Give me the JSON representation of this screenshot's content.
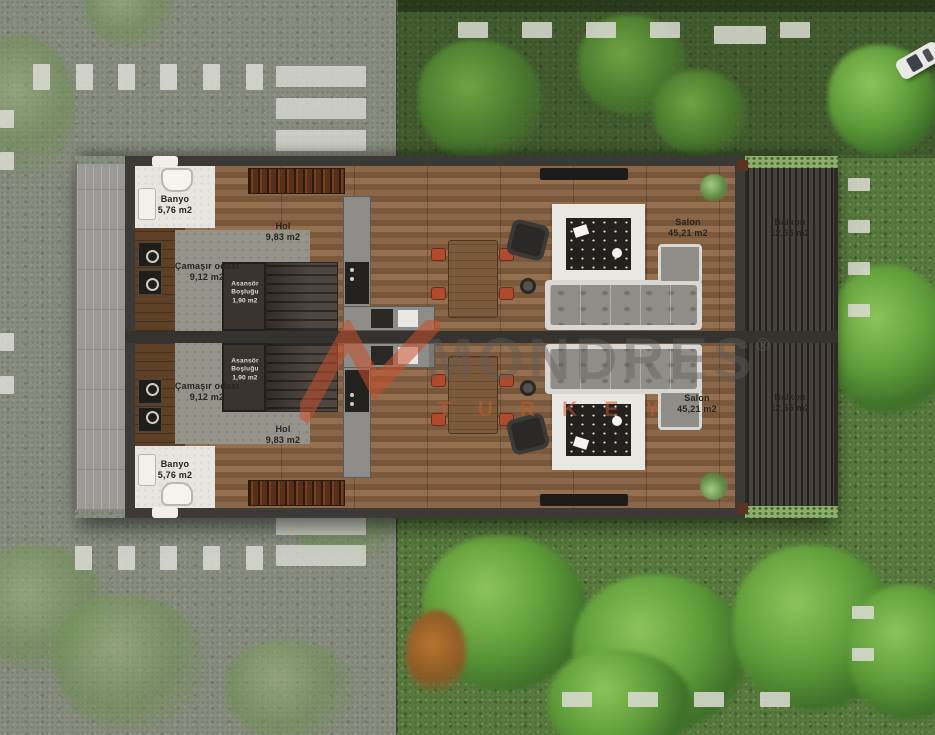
{
  "title": "Site floor plan - duplex units",
  "units": {
    "top": {
      "banyo": {
        "name": "Banyo",
        "area": "5,76 m2"
      },
      "camasir": {
        "name": "Çamaşır odası",
        "area": "9,12 m2"
      },
      "hol": {
        "name": "Hol",
        "area": "9,83 m2"
      },
      "asansor": {
        "name": "Asansör",
        "line2": "Boşluğu",
        "area": "1,90 m2"
      },
      "salon": {
        "name": "Salon",
        "area": "45,21 m2"
      },
      "balkon": {
        "name": "Balkon",
        "area": "12,55 m2"
      }
    },
    "bottom": {
      "banyo": {
        "name": "Banyo",
        "area": "5,76 m2"
      },
      "camasir": {
        "name": "Çamaşır odası",
        "area": "9,12 m2"
      },
      "hol": {
        "name": "Hol",
        "area": "9,83 m2"
      },
      "asansor": {
        "name": "Asansör",
        "line2": "Boşluğu",
        "area": "1,90 m2"
      },
      "salon": {
        "name": "Salon",
        "area": "45,21 m2"
      },
      "balkon": {
        "name": "Balkon",
        "area": "12,55 m2"
      }
    }
  },
  "watermark": {
    "brand": "MONDRES",
    "reg": "®",
    "tagline": "TURKEY"
  },
  "palette": {
    "road": "#878c7e",
    "grass": "#587a3e",
    "wood_floor": "#8a6749",
    "wall": "#3b3a37",
    "balcony_deck": "#47423c",
    "marking_white": "#dcdcd4",
    "chair_red": "#b04a2d",
    "flower_orange": "#c2632f",
    "flower_blue": "#3e6f9e",
    "watermark_orange": "#c9502c",
    "watermark_gray": "#5f5d5a"
  }
}
